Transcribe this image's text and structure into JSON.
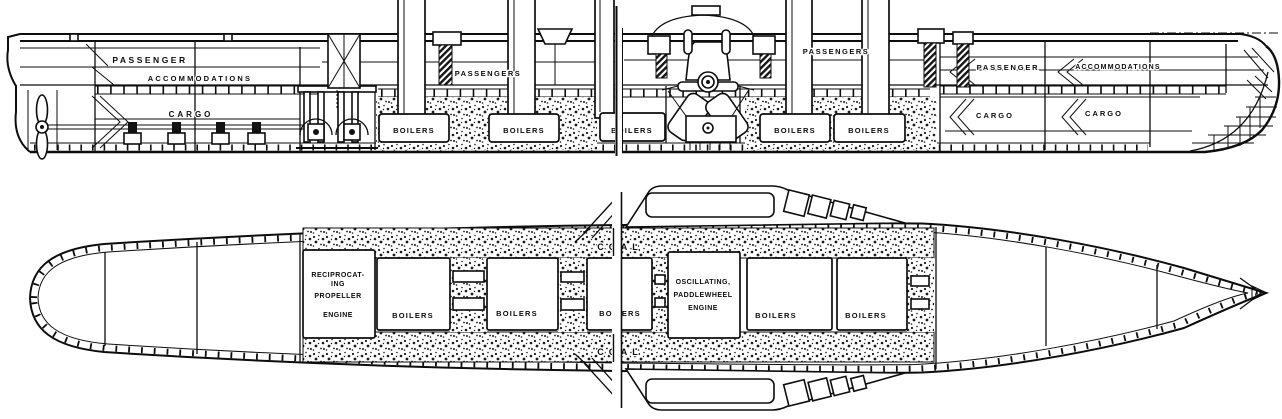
{
  "colors": {
    "ink": "#0d0d0d",
    "paper": "#ffffff"
  },
  "elevation": {
    "aft": {
      "passenger": "PASSENGER",
      "accommodations": "ACCOMMODATIONS",
      "cargo": "CARGO"
    },
    "mid": {
      "passengers_aft_half": "PASSENGERS",
      "passengers_fwd_half": "PASSENGERS"
    },
    "fwd": {
      "passenger": "PASSENGER",
      "accommodations": "ACCOMMODATIONS",
      "cargo_1": "CARGO",
      "cargo_2": "CARGO"
    },
    "boilers": [
      "BOILERS",
      "BOILERS",
      "BOILERS",
      "BOILERS",
      "BOILERS"
    ]
  },
  "plan": {
    "reciprocating_engine": {
      "line1": "RECIPROCAT-",
      "line2": "ING",
      "line3": "PROPELLER",
      "line4": "ENGINE"
    },
    "oscillating_engine": {
      "line1": "OSCILLATING,",
      "line2": "PADDLEWHEEL",
      "line3": "ENGINE"
    },
    "boilers": [
      "BOILERS",
      "BOILERS",
      "BOILERS",
      "BOILERS",
      "BOILERS"
    ],
    "coal_top": "COAL",
    "coal_bottom": "COAL"
  }
}
